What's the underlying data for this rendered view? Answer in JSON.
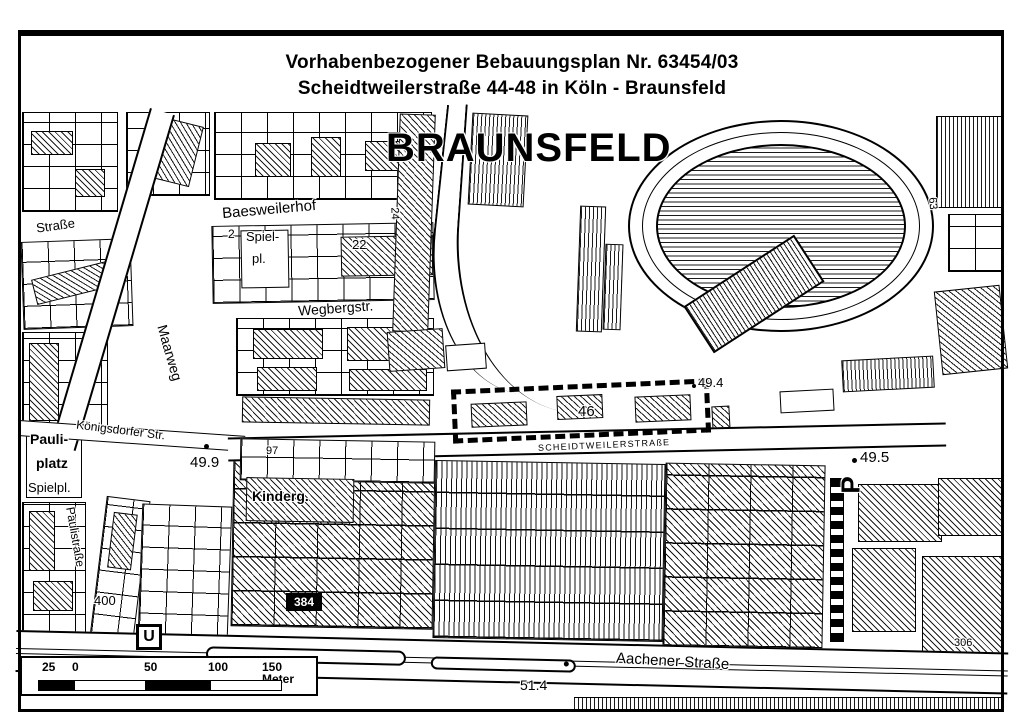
{
  "title": {
    "line1": "Vorhabenbezogener Bebauungsplan Nr. 63454/03",
    "line2": "Scheidtweilerstraße 44-48 in Köln - Braunsfeld"
  },
  "district": "BRAUNSFELD",
  "streets": {
    "baesweilerhof": "Baesweilerhof",
    "wegbergstr": "Wegbergstr.",
    "maarweg": "Maarweg",
    "koenigsdorfer_str": "Königsdorfer Str.",
    "scheidtweilerstrasse": "SCHEIDTWEILERSTRAßE",
    "aachener_strasse": "Aachener Straße",
    "paulistrasse": "Paulistraße",
    "strasse_partial": "Straße"
  },
  "places": {
    "pauliplatz_line1": "Pauli-",
    "pauliplatz_line2": "platz",
    "spielplatz_nord_line1": "Spiel-",
    "spielplatz_nord_line2": "pl.",
    "spielplatz_sued": "Spielpl.",
    "kindergarten": "Kinderg."
  },
  "elevations": {
    "e499": "49.9",
    "e494": "49.4",
    "e495": "49.5",
    "e514": "51.4"
  },
  "numbers": {
    "n2": "2",
    "n22": "22",
    "n24": "24",
    "n97": "97",
    "n46": "46",
    "n384": "384",
    "n400": "400",
    "n306": "306",
    "n63": "63"
  },
  "symbols": {
    "ubahn": "U",
    "parking": "P"
  },
  "scalebar": {
    "m25": "25",
    "m0": "0",
    "m50": "50",
    "m100": "100",
    "m150": "150 Meter"
  }
}
